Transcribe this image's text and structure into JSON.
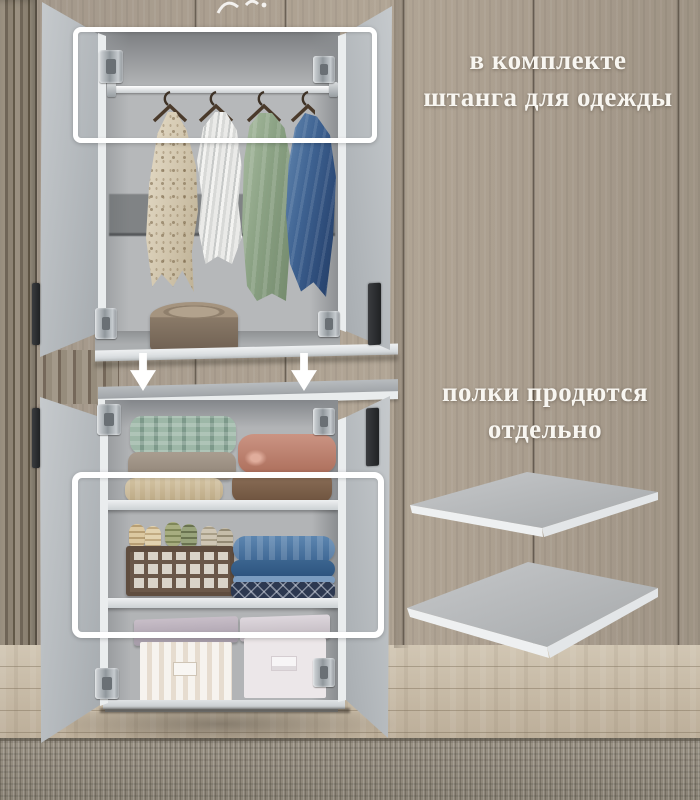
{
  "annotations": {
    "rod_note": {
      "line1": "в комплекте",
      "line2": "штанга для одежды"
    },
    "shelves_note": {
      "line1": "полки продются",
      "line2": "отдельно"
    }
  },
  "icons": {
    "arrow_left": "down-arrow-icon",
    "arrow_right": "down-arrow-icon"
  },
  "palette": {
    "annotation_white": "#ffffff",
    "wall_taupe": "#a99e8f",
    "cabinet_gray": "#b5babd",
    "floor_wood": "#c9bda9",
    "carpet_gray": "#968f82",
    "denim_blue": "#3f6392",
    "sage_green": "#8aa183",
    "terracotta": "#bd8470",
    "teal_knit": "#8ba79a"
  }
}
